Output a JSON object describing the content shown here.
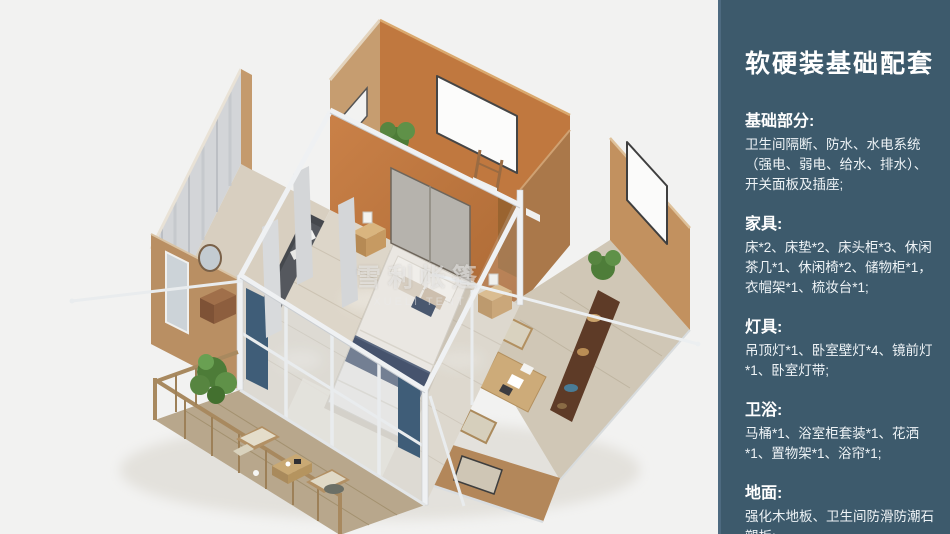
{
  "page": {
    "background": "#f2f2f1"
  },
  "render": {
    "subject": "isometric-3d-cutaway-floorplan-of-glamping-tent-house",
    "watermark": {
      "line1": "雪利帐篷",
      "line2": "XUELI TENT"
    },
    "palette": {
      "wall_orange": "#c0783f",
      "wall_tan": "#c29663",
      "frame_white": "#eff1f3",
      "floor_wood": "#ddd6c9",
      "deck_wood": "#b8a78c",
      "accent_navy": "#46536d",
      "plant_green": "#4d7c38",
      "cushion_beige": "#e4ddca"
    }
  },
  "sidebar": {
    "background": "#3d5a6c",
    "title": "软硬装基础配套",
    "sections": [
      {
        "heading": "基础部分:",
        "body": "卫生间隔断、防水、水电系统（强电、弱电、给水、排水）、开关面板及插座;"
      },
      {
        "heading": "家具:",
        "body": "床*2、床垫*2、床头柜*3、休闲茶几*1、休闲椅*2、储物柜*1，衣帽架*1、梳妆台*1;"
      },
      {
        "heading": "灯具:",
        "body": "吊顶灯*1、卧室壁灯*4、镜前灯*1、卧室灯带;"
      },
      {
        "heading": "卫浴:",
        "body": "马桶*1、浴室柜套装*1、花洒*1、置物架*1、浴帘*1;"
      },
      {
        "heading": "地面:",
        "body": "强化木地板、卫生间防滑防潮石塑板;"
      }
    ]
  }
}
